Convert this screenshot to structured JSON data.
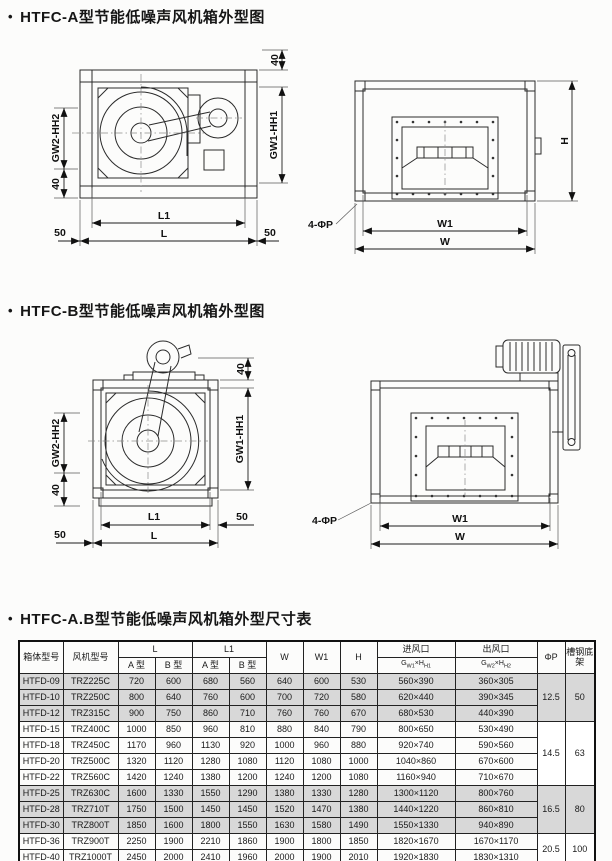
{
  "titles": {
    "bullet": "•",
    "section_a": "HTFC-A型节能低噪声风机箱外型图",
    "section_b": "HTFC-B型节能低噪声风机箱外型图",
    "section_table": "HTFC-A.B型节能低噪声风机箱外型尺寸表"
  },
  "dims": {
    "forty": "40",
    "fifty": "50",
    "L": "L",
    "L1": "L1",
    "W": "W",
    "W1": "W1",
    "H": "H",
    "gw1hh1": "GW1-HH1",
    "gw2hh2": "GW2-HH2",
    "four_phi_p": "4-ΦP"
  },
  "table": {
    "headers": {
      "box_model": "箱体型号",
      "fan_model": "风机型号",
      "L": "L",
      "L1": "L1",
      "type_a": "A 型",
      "type_b": "B 型",
      "W": "W",
      "W1": "W1",
      "H": "H",
      "inlet": "进风口",
      "outlet": "出风口",
      "inlet_sub": {
        "g": "G",
        "s1": "W1",
        "times": "×",
        "h": "H",
        "s2": "H1"
      },
      "outlet_sub": {
        "g": "G",
        "s1": "W2",
        "times": "×",
        "h": "H",
        "s2": "H2"
      },
      "phi_p": "ΦP",
      "base": "槽钢底架"
    },
    "rows": [
      {
        "box": "HTFD-09",
        "fan": "TRZ225C",
        "la": "720",
        "lb": "600",
        "l1a": "680",
        "l1b": "560",
        "w": "640",
        "w1": "600",
        "h": "530",
        "inlet": "560×390",
        "outlet": "360×305"
      },
      {
        "box": "HTFD-10",
        "fan": "TRZ250C",
        "la": "800",
        "lb": "640",
        "l1a": "760",
        "l1b": "600",
        "w": "700",
        "w1": "720",
        "h": "580",
        "inlet": "620×440",
        "outlet": "390×345"
      },
      {
        "box": "HTFD-12",
        "fan": "TRZ315C",
        "la": "900",
        "lb": "750",
        "l1a": "860",
        "l1b": "710",
        "w": "760",
        "w1": "760",
        "h": "670",
        "inlet": "680×530",
        "outlet": "440×390"
      },
      {
        "box": "HTFD-15",
        "fan": "TRZ400C",
        "la": "1000",
        "lb": "850",
        "l1a": "960",
        "l1b": "810",
        "w": "880",
        "w1": "840",
        "h": "790",
        "inlet": "800×650",
        "outlet": "530×490"
      },
      {
        "box": "HTFD-18",
        "fan": "TRZ450C",
        "la": "1170",
        "lb": "960",
        "l1a": "1130",
        "l1b": "920",
        "w": "1000",
        "w1": "960",
        "h": "880",
        "inlet": "920×740",
        "outlet": "590×560"
      },
      {
        "box": "HTFD-20",
        "fan": "TRZ500C",
        "la": "1320",
        "lb": "1120",
        "l1a": "1280",
        "l1b": "1080",
        "w": "1120",
        "w1": "1080",
        "h": "1000",
        "inlet": "1040×860",
        "outlet": "670×600"
      },
      {
        "box": "HTFD-22",
        "fan": "TRZ560C",
        "la": "1420",
        "lb": "1240",
        "l1a": "1380",
        "l1b": "1200",
        "w": "1240",
        "w1": "1200",
        "h": "1080",
        "inlet": "1160×940",
        "outlet": "710×670"
      },
      {
        "box": "HTFD-25",
        "fan": "TRZ630C",
        "la": "1600",
        "lb": "1330",
        "l1a": "1550",
        "l1b": "1290",
        "w": "1380",
        "w1": "1330",
        "h": "1280",
        "inlet": "1300×1120",
        "outlet": "800×760"
      },
      {
        "box": "HTFD-28",
        "fan": "TRZ710T",
        "la": "1750",
        "lb": "1500",
        "l1a": "1450",
        "l1b": "1450",
        "w": "1520",
        "w1": "1470",
        "h": "1380",
        "inlet": "1440×1220",
        "outlet": "860×810"
      },
      {
        "box": "HTFD-30",
        "fan": "TRZ800T",
        "la": "1850",
        "lb": "1600",
        "l1a": "1800",
        "l1b": "1550",
        "w": "1630",
        "w1": "1580",
        "h": "1490",
        "inlet": "1550×1330",
        "outlet": "940×890"
      },
      {
        "box": "HTFD-36",
        "fan": "TRZ900T",
        "la": "2250",
        "lb": "1900",
        "l1a": "2210",
        "l1b": "1860",
        "w": "1900",
        "w1": "1800",
        "h": "1850",
        "inlet": "1820×1670",
        "outlet": "1670×1170"
      },
      {
        "box": "HTFD-40",
        "fan": "TRZ1000T",
        "la": "2450",
        "lb": "2000",
        "l1a": "2410",
        "l1b": "1960",
        "w": "2000",
        "w1": "1900",
        "h": "2010",
        "inlet": "1920×1830",
        "outlet": "1830×1310"
      }
    ],
    "groups": [
      {
        "rows": [
          0,
          1,
          2
        ],
        "phi_p": "12.5",
        "base": "50",
        "shaded": true
      },
      {
        "rows": [
          3,
          4,
          5,
          6
        ],
        "phi_p": "14.5",
        "base": "63",
        "shaded": false
      },
      {
        "rows": [
          7,
          8,
          9
        ],
        "phi_p": "16.5",
        "base": "80",
        "shaded": true
      },
      {
        "rows": [
          10,
          11
        ],
        "phi_p": "20.5",
        "base": "100",
        "shaded": false
      }
    ]
  }
}
